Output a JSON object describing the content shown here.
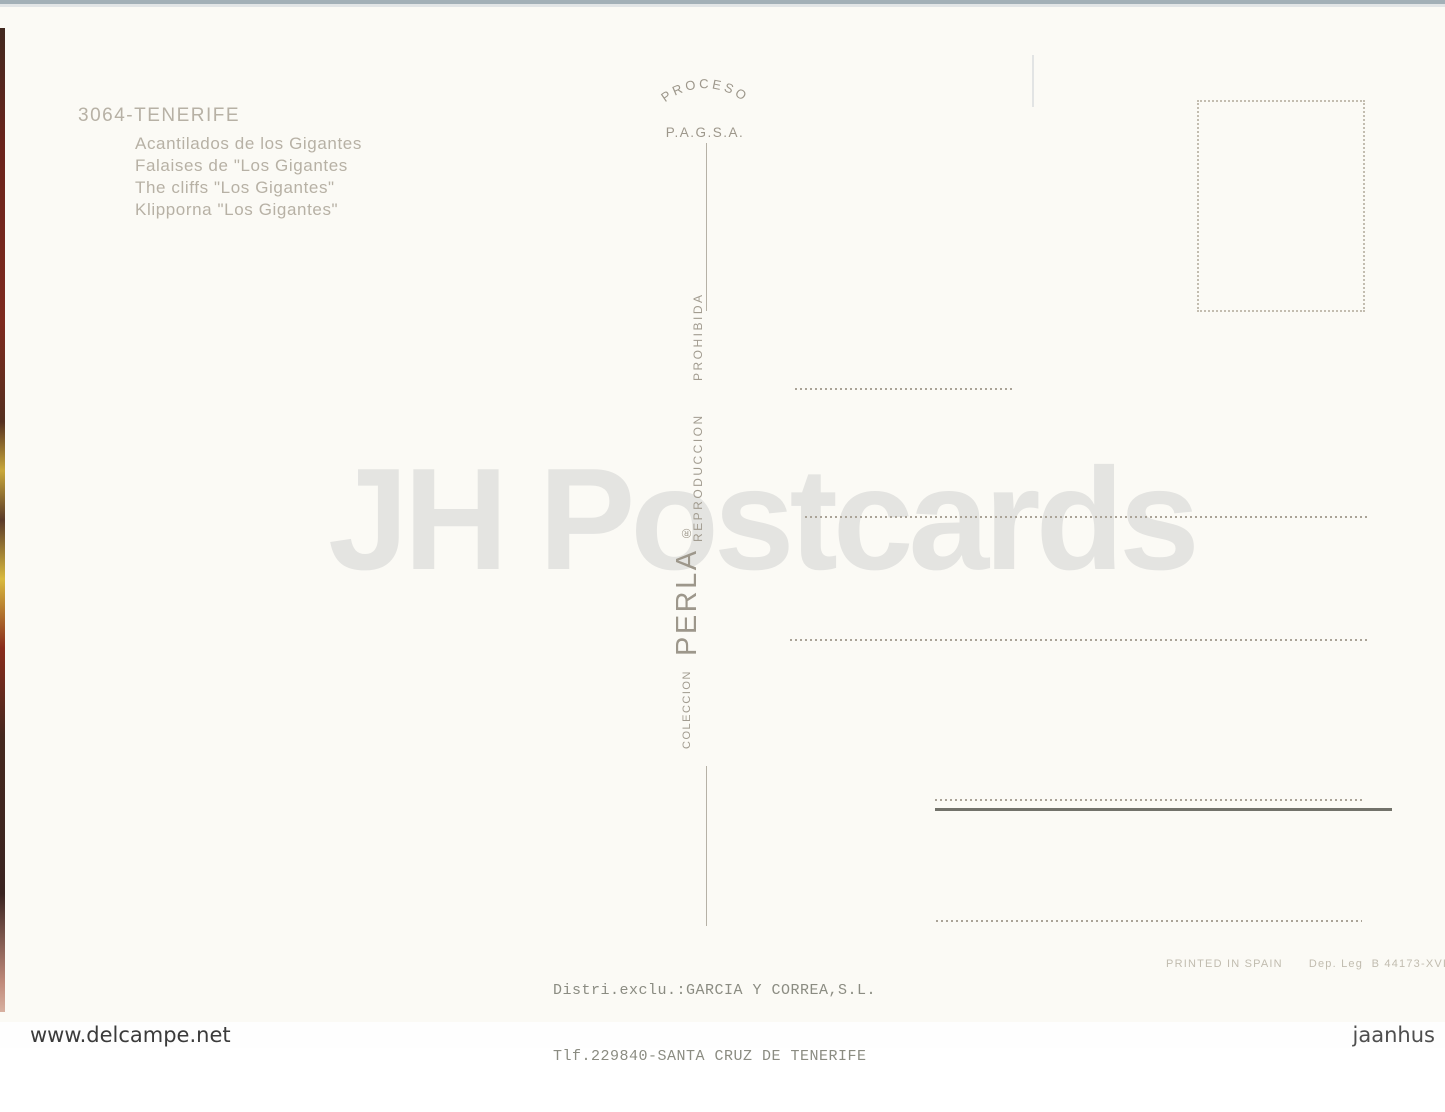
{
  "watermark": {
    "text": "JH Postcards"
  },
  "header": {
    "title": "3064-TENERIFE",
    "subtitles": [
      "Acantilados de los Gigantes",
      "Falaises de \"Los Gigantes",
      "The cliffs \"Los Gigantes\"",
      "Klipporna \"Los Gigantes\""
    ]
  },
  "process_mark": {
    "arc_text": "PROCESO",
    "sub_text": "P.A.G.S.A."
  },
  "divider": {
    "reproduction_word1": "REPRODUCCION",
    "reproduction_word2": "PROHIBIDA",
    "collection_label": "COLECCION",
    "brand": "PERLA",
    "registered": "®"
  },
  "distributor": {
    "line1": "Distri.exclu.:GARCIA Y CORREA,S.L.",
    "line2": "Tlf.229840-SANTA CRUZ DE TENERIFE"
  },
  "imprint": {
    "printed": "PRINTED IN SPAIN",
    "deposit": "Dep. Leg  B 44173-XVI"
  },
  "scan_footer": {
    "left": "www.delcampe.net",
    "right": "jaanhus"
  },
  "colors": {
    "card_bg": "#fbfaf5",
    "faded_ink": "#b7b1a5",
    "divider_ink": "#a29c90",
    "typewriter_ink": "#8b8c82",
    "imprint_ink": "#c1bcaf",
    "watermark": "#e4e4e1",
    "dotted_line": "#aaa397",
    "solid_line": "#72726a",
    "top_strip": "#a3b0b7"
  }
}
